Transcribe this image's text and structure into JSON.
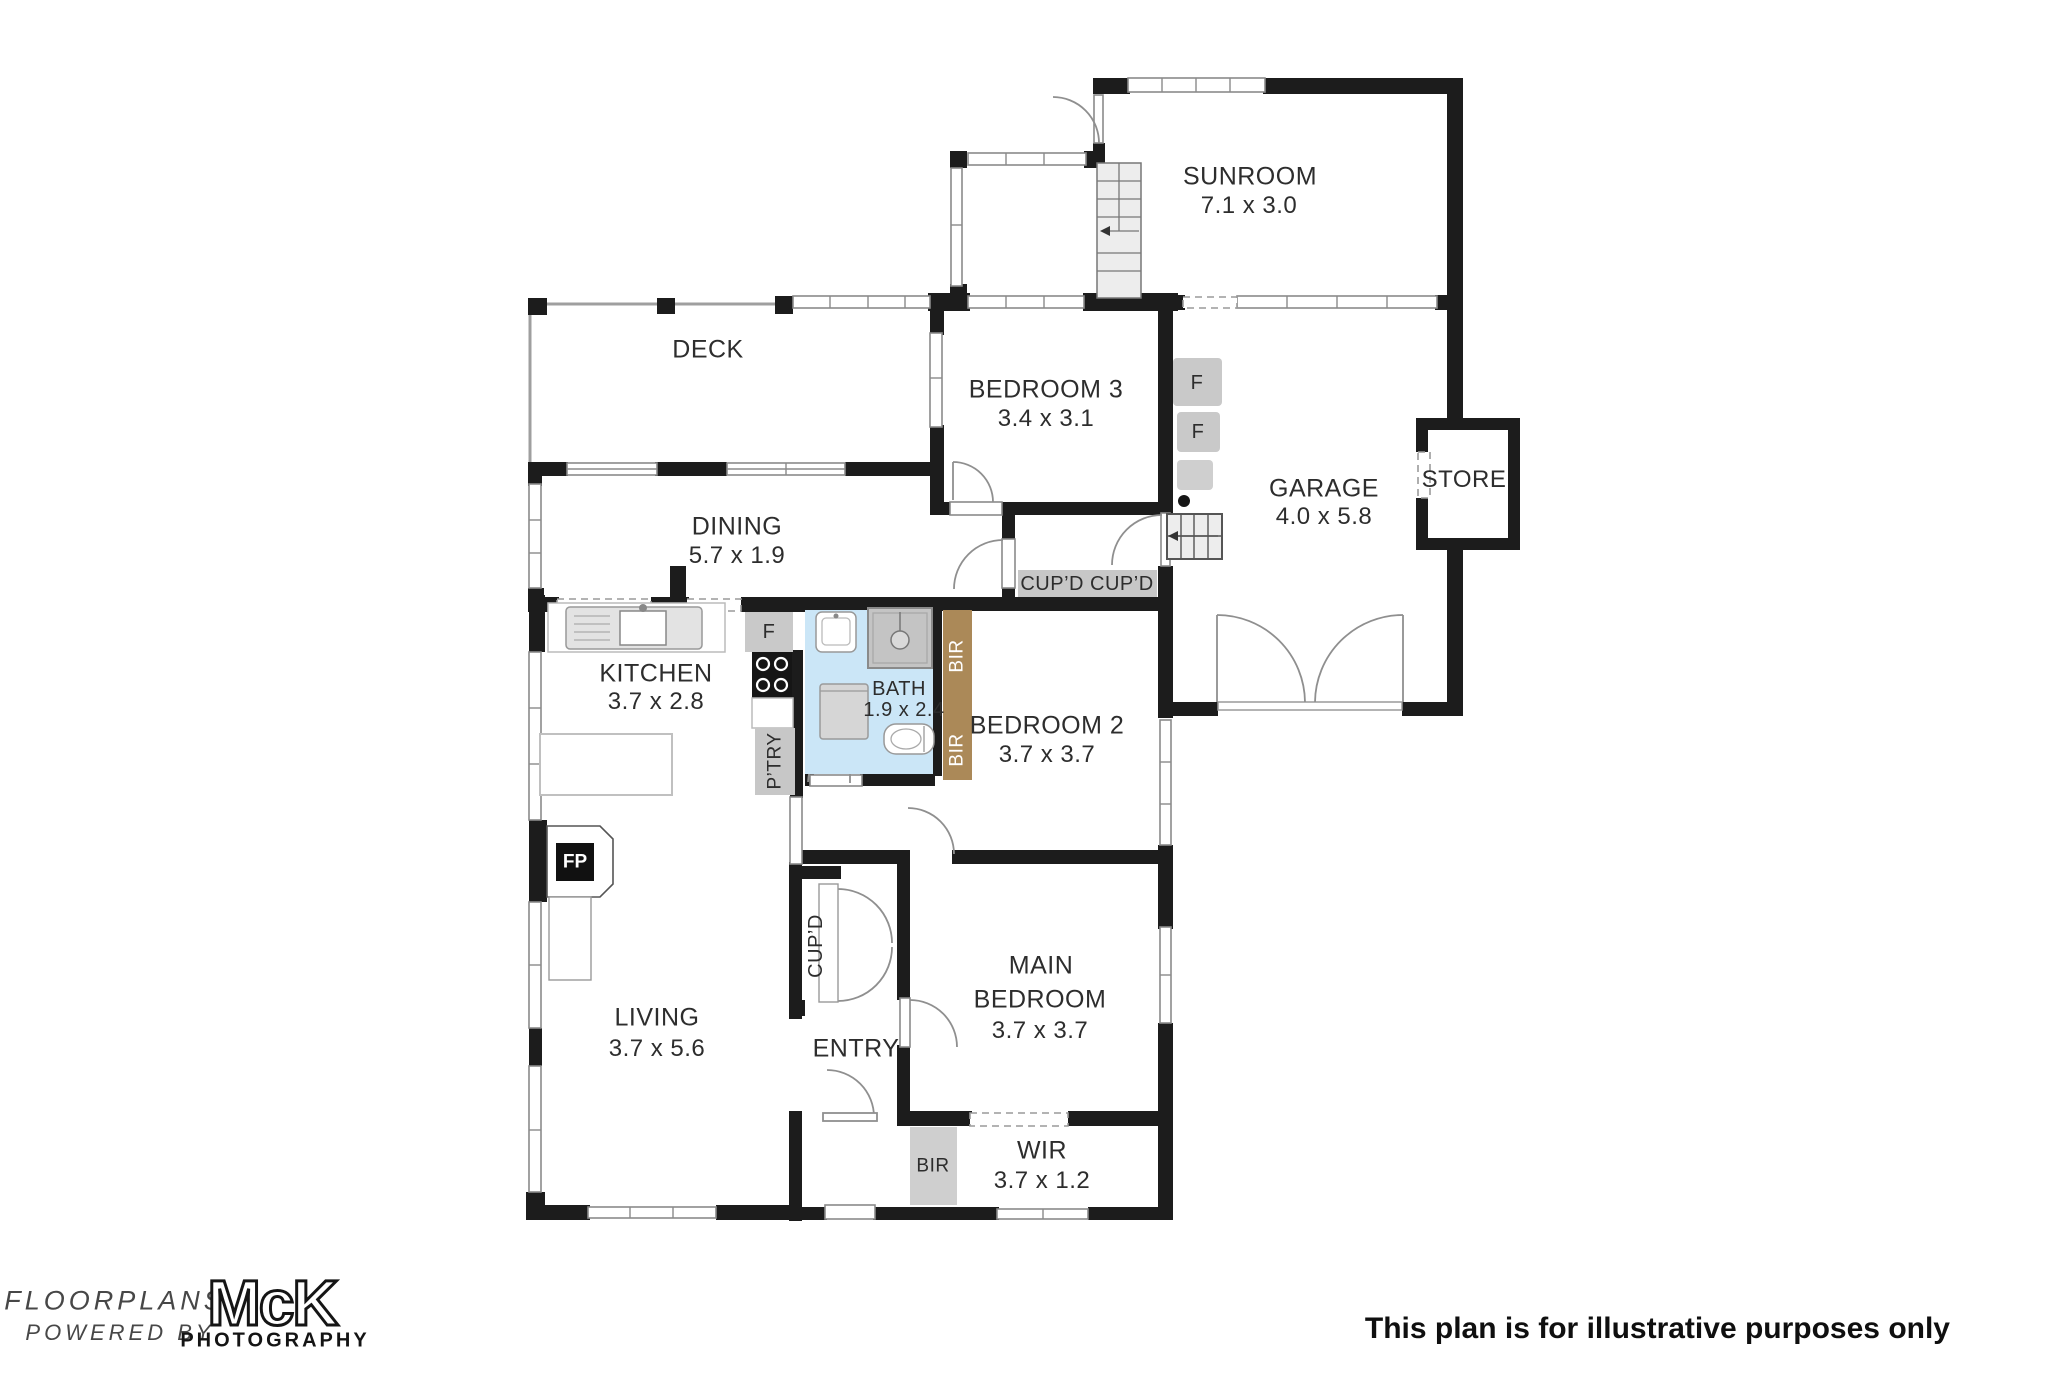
{
  "rooms": {
    "deck": {
      "name": "DECK"
    },
    "dining": {
      "name": "DINING",
      "dims": "5.7 x 1.9"
    },
    "kitchen": {
      "name": "KITCHEN",
      "dims": "3.7 x 2.8"
    },
    "living": {
      "name": "LIVING",
      "dims": "3.7 x 5.6"
    },
    "entry": {
      "name": "ENTRY"
    },
    "bath": {
      "name": "BATH",
      "dims": "1.9 x 2.4"
    },
    "bedroom2": {
      "name": "BEDROOM 2",
      "dims": "3.7 x 3.7"
    },
    "bedroom3": {
      "name": "BEDROOM 3",
      "dims": "3.4 x 3.1"
    },
    "main_bedroom": {
      "line1": "MAIN",
      "line2": "BEDROOM",
      "dims": "3.7 x 3.7"
    },
    "wir": {
      "name": "WIR",
      "dims": "3.7 x 1.2"
    },
    "sunroom": {
      "name": "SUNROOM",
      "dims": "7.1 x 3.0"
    },
    "garage": {
      "name": "GARAGE",
      "dims": "4.0 x 5.8"
    },
    "store": {
      "name": "STORE"
    }
  },
  "fixtures": {
    "fireplace": "FP",
    "fridge": "F",
    "pantry": "P’TRY",
    "cupboard": "CUP’D",
    "cupboard_double": "CUP’D CUP’D",
    "robe": "BIR"
  },
  "footer": {
    "logo_line1": "FLOORPLANS",
    "logo_line2": "POWERED BY",
    "logo_name": "McK",
    "logo_sub": "PHOTOGRAPHY",
    "disclaimer": "This plan is for illustrative purposes only"
  },
  "colors": {
    "wall": "#1c1c1c",
    "robe_timber": "#ab8958",
    "strip_grey": "#c7c7c7",
    "bath_blue": "#cbe6f7"
  }
}
